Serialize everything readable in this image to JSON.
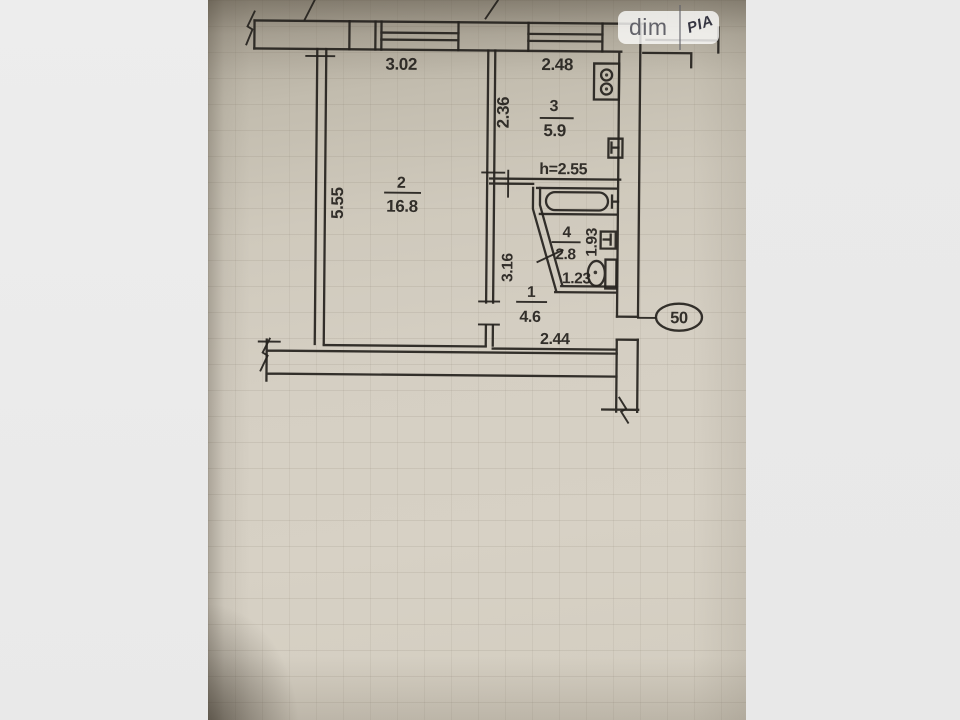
{
  "watermark": {
    "brand": "dim",
    "logo": "РІА"
  },
  "plan": {
    "apartment_number": "50",
    "ceiling_height_label": "h=2.55",
    "rooms": [
      {
        "number": "2",
        "area": "16.8",
        "width": "3.02",
        "height": "5.55"
      },
      {
        "number": "3",
        "area": "5.9",
        "width": "2.48",
        "height": "2.36"
      },
      {
        "number": "4",
        "area": "2.8",
        "width": "1.23",
        "height": "1.93"
      },
      {
        "number": "1",
        "area": "4.6",
        "width": "2.44",
        "height": "3.16"
      }
    ]
  },
  "colors": {
    "paper": "#d4cec2",
    "ink": "#26231f",
    "side_bar_left": "#ececec",
    "side_bar_right": "#e9e9e9",
    "watermark_bg": "#fdfdfb"
  }
}
